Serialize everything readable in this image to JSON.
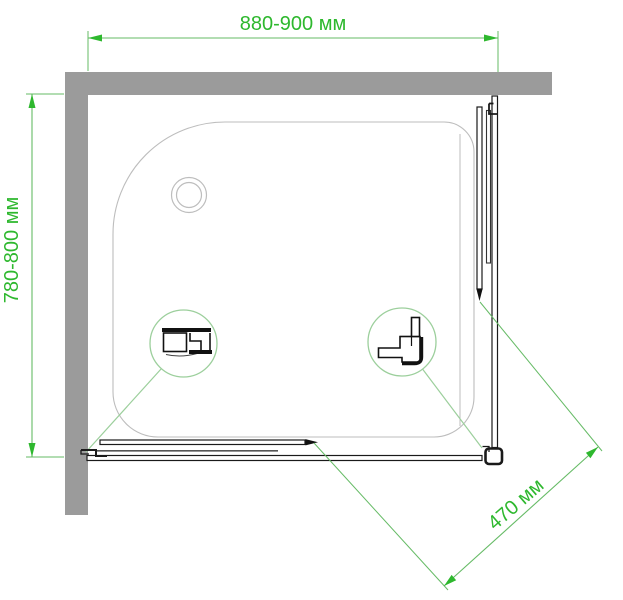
{
  "drawing": {
    "type": "shower-enclosure-plan-view",
    "labels": {
      "width": "880-900 мм",
      "depth": "780-800 мм",
      "entry": "470 мм"
    },
    "colors": {
      "dimension_text": "#2eb82e",
      "dimension_line": "#66bb66",
      "detail_line": "#9ccf9c",
      "wall": "#9b9b9b",
      "tray_outline": "#bdbdbd",
      "frame": "#1a1a1a"
    }
  }
}
